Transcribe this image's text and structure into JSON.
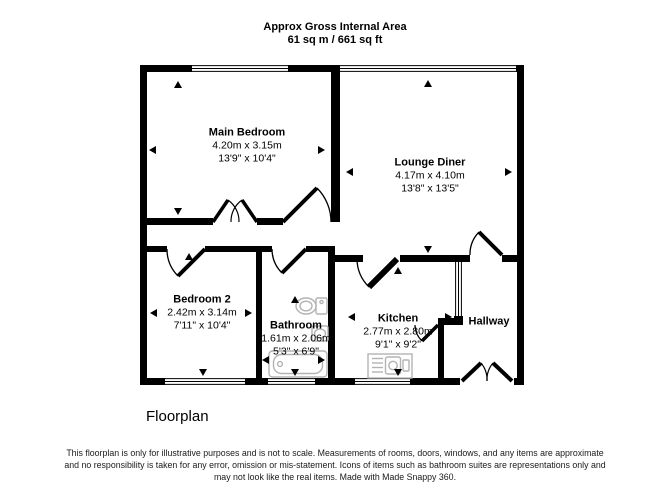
{
  "header": {
    "title": "Approx Gross Internal Area",
    "area": "61 sq m / 661 sq ft"
  },
  "rooms": [
    {
      "name": "Main Bedroom",
      "metric": "4.20m x 3.15m",
      "imperial": "13'9\" x 10'4\""
    },
    {
      "name": "Lounge Diner",
      "metric": "4.17m x 4.10m",
      "imperial": "13'8\" x 13'5\""
    },
    {
      "name": "Bedroom 2",
      "metric": "2.42m x 3.14m",
      "imperial": "7'11\" x 10'4\""
    },
    {
      "name": "Bathroom",
      "metric": "1.61m x 2.06m",
      "imperial": "5'3\" x 6'9\""
    },
    {
      "name": "Kitchen",
      "metric": "2.77m x 2.80m",
      "imperial": "9'1\" x 9'2\""
    },
    {
      "name": "Hallway"
    }
  ],
  "caption": "Floorplan",
  "disclaimer": {
    "line1": "This floorplan is only for illustrative purposes and is not to scale. Measurements of rooms, doors, windows, and any items are approximate",
    "line2": "and no responsibility is taken for any error, omission or mis-statement. Icons of items such as bathroom suites are representations only and",
    "line3": "may not look like the real items. Made with Made Snappy 360."
  },
  "icons": [
    "toilet-icon",
    "basin-icon",
    "bathtub-icon",
    "kitchen-sink-icon",
    "window-glyph",
    "door-swing-icon",
    "dimension-arrow-icon"
  ],
  "colors": {
    "wall": "#000000",
    "fixture": "#b3b3b3",
    "text": "#000000",
    "background": "#ffffff"
  }
}
